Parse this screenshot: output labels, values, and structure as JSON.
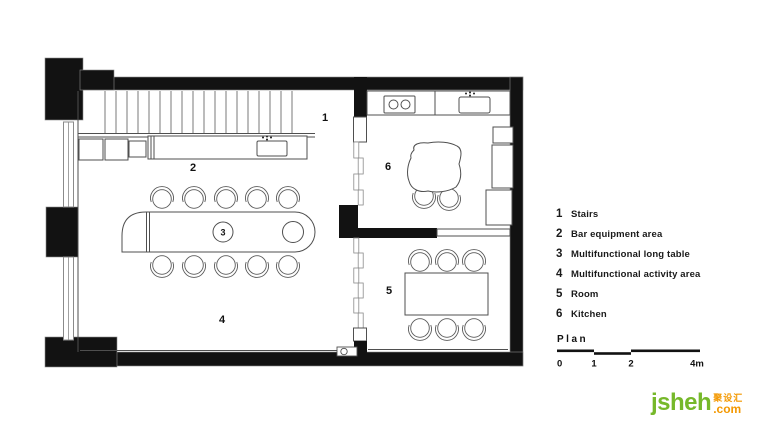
{
  "legend": {
    "items": [
      {
        "number": "1",
        "label": "Stairs"
      },
      {
        "number": "2",
        "label": "Bar equipment area"
      },
      {
        "number": "3",
        "label": "Multifunctional long table"
      },
      {
        "number": "4",
        "label": "Multifunctional activity area"
      },
      {
        "number": "5",
        "label": "Room"
      },
      {
        "number": "6",
        "label": "Kitchen"
      }
    ]
  },
  "plan": {
    "labels": [
      "1",
      "2",
      "3",
      "4",
      "5",
      "6"
    ]
  },
  "scale_bar": {
    "title": "Plan",
    "ticks": [
      "0",
      "1",
      "2",
      "4m"
    ]
  },
  "logo": {
    "name": "jsheh",
    "cjk": "聚设汇",
    "tld": ".com"
  },
  "colors": {
    "wall": "#121212",
    "line": "#4f4f4f",
    "logo_green": "#76b82a",
    "logo_orange": "#f39800"
  }
}
